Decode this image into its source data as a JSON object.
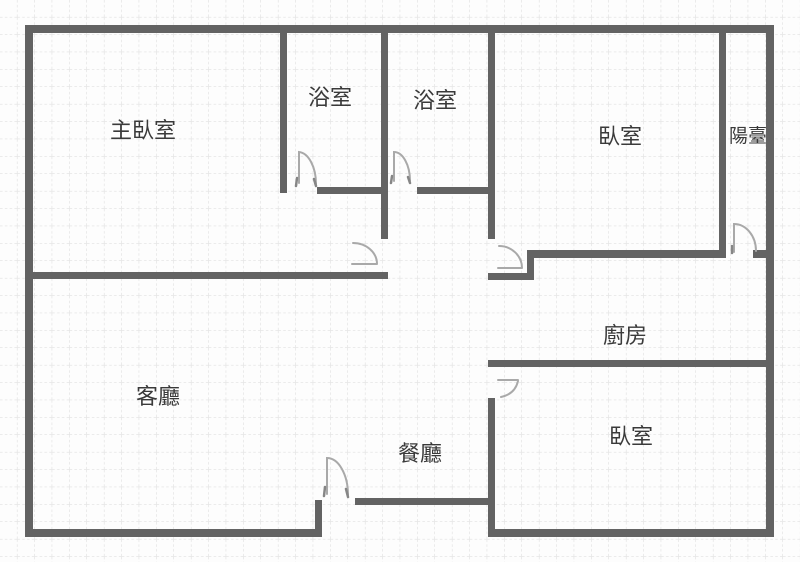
{
  "figure": {
    "type": "floor-plan",
    "style": "hand-drawn grid paper apartment plan"
  },
  "colors": {
    "background": "#fdfdfd",
    "grid": "#d9d9d9",
    "wall": "#636363",
    "door": "#a9a9a9",
    "door_accent": "#868686",
    "text": "#3a3a3a"
  },
  "rooms": {
    "master_bedroom": {
      "label": "主臥室"
    },
    "bathroom_1": {
      "label": "浴室"
    },
    "bathroom_2": {
      "label": "浴室"
    },
    "bedroom_top_right": {
      "label": "臥室"
    },
    "balcony": {
      "label": "陽臺"
    },
    "living_room": {
      "label": "客廳"
    },
    "dining_room": {
      "label": "餐廳"
    },
    "kitchen": {
      "label": "廚房"
    },
    "bedroom_bottom_right": {
      "label": "臥室"
    }
  }
}
